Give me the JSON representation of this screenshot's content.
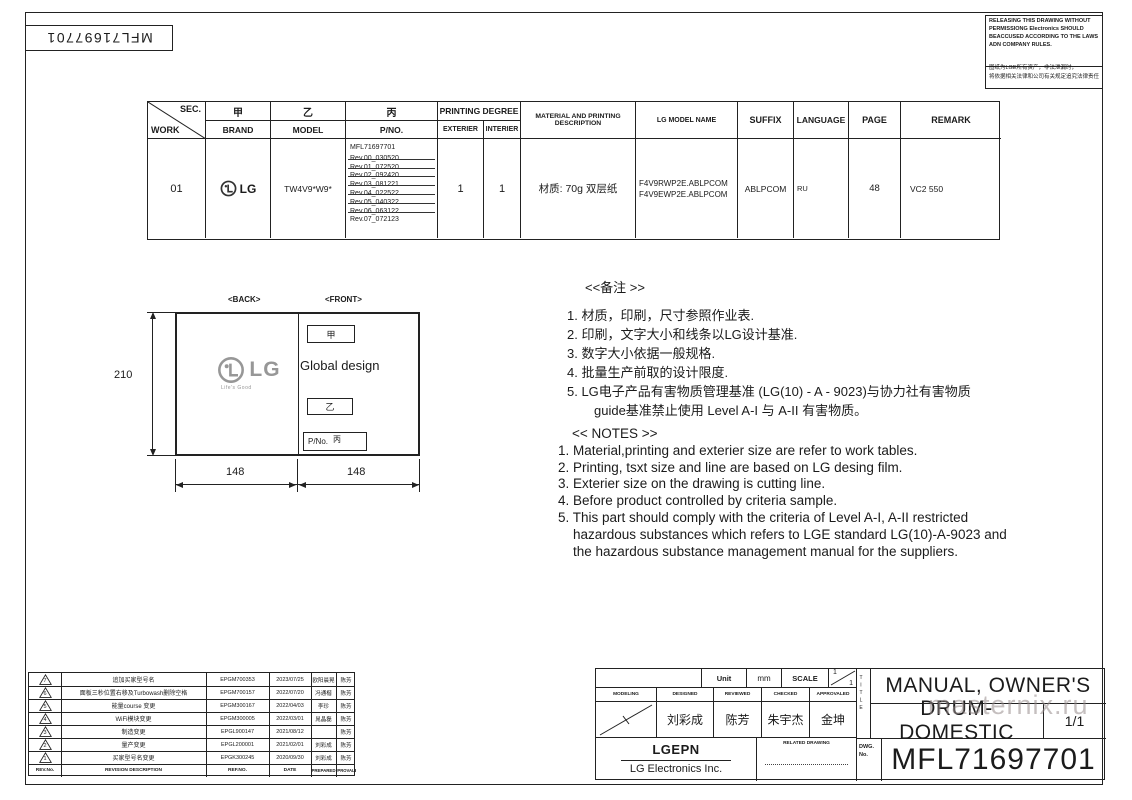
{
  "corner": {
    "doc_number": "MFL71697701"
  },
  "watermark": "masternix.ru",
  "release_box": {
    "en": "RELEASING THIS DRAWING WITHOUT PERMISSIONG Electronics SHOULD BEACCUSED ACCORDING TO THE LAWS ADN COMPANY RULES.",
    "cn_line1": "图纸为LGE所有资产，非法泄漏时，",
    "cn_line2": "将依据相关法律和公司有关规定追究法律责任"
  },
  "work_table": {
    "sec_label": "SEC.",
    "work_label": "WORK",
    "jia": "甲",
    "yi": "乙",
    "bing": "丙",
    "brand_label": "BRAND",
    "model_label": "MODEL",
    "pno_label": "P/NO.",
    "printing_degree_label": "PRINTING DEGREE",
    "exterier_label": "EXTERIER",
    "interier_label": "INTERIER",
    "material_label": "MATERIAL AND PRINTING DESCRIPTION",
    "lg_model_label": "LG MODEL NAME",
    "suffix_label": "SUFFIX",
    "language_label": "LANGUAGE",
    "page_label": "PAGE",
    "remark_label": "REMARK",
    "row": {
      "work": "01",
      "brand": "LG",
      "model": "TW4V9*W9*",
      "pno_part": "MFL71697701",
      "revs_struck": [
        "Rev.00_030520",
        "Rev.01_072520",
        "Rev.02_092420",
        "Rev.03_081221",
        "Rev.04_022522",
        "Rev.05_040322",
        "Rev.06_063122"
      ],
      "rev_current": "Rev.07_072123",
      "exterier": "1",
      "interier": "1",
      "material": "材质: 70g 双层纸",
      "lg_model_1": "F4V9RWP2E.ABLPCOM",
      "lg_model_2": "F4V9EWP2E.ABLPCOM",
      "suffix": "ABLPCOM",
      "language": "RU",
      "page": "48",
      "remark": "VC2 550"
    }
  },
  "drawing": {
    "back_label": "<BACK>",
    "front_label": "<FRONT>",
    "logo_text": "LG",
    "logo_tagline": "Life's Good",
    "front_jia": "甲",
    "front_design": "Global design",
    "front_yi": "乙",
    "front_pno_label": "P/No.",
    "front_bing": "丙",
    "dim_height": "210",
    "dim_width_left": "148",
    "dim_width_right": "148"
  },
  "notes_cn": {
    "heading": "<<备注 >>",
    "lines": [
      "1.  材质，印刷，尺寸参照作业表.",
      "2.  印刷，文字大小和线条以LG设计基准.",
      "3.  数字大小依据一般规格.",
      "4.  批量生产前取的设计限度.",
      "5.  LG电子产品有害物质管理基准 (LG(10) - A - 9023)与协力社有害物质",
      "guide基准禁止使用 Level A-I 与 A-II 有害物质。"
    ]
  },
  "notes_en": {
    "heading": "<< NOTES >>",
    "lines": [
      "1. Material,printing and exterier size are refer to work tables.",
      "2. Printing, tsxt  size and line are based on LG desing film.",
      "3. Exterier size on the drawing is cutting line.",
      "4. Before product controlled by criteria sample.",
      "5. This part should comply with the criteria of Level A-I, A-II restricted",
      "hazardous substances which refers to LGE standard LG(10)-A-9023 and",
      "the hazardous substance management manual for the suppliers."
    ]
  },
  "revision_table": {
    "rows": [
      {
        "no": "7",
        "desc": "追加买家型号名",
        "ref": "EPGM700353",
        "date": "2023/07/25",
        "prepared": "欧阳晨晃",
        "approved": "陈芳"
      },
      {
        "no": "6",
        "desc": "面板三秒位置右移及Turbowash删除空格",
        "ref": "EPGM700157",
        "date": "2022/07/20",
        "prepared": "冯通楷",
        "approved": "陈芳"
      },
      {
        "no": "5",
        "desc": "能量course 变更",
        "ref": "EPGM300167",
        "date": "2022/04/03",
        "prepared": "李珍",
        "approved": "陈芳"
      },
      {
        "no": "4",
        "desc": "WiFi模块变更",
        "ref": "EPGM300005",
        "date": "2022/03/01",
        "prepared": "晁晶磊",
        "approved": "陈芳"
      },
      {
        "no": "3",
        "desc": "制造变更",
        "ref": "EPGL900147",
        "date": "2021/08/12",
        "prepared": "",
        "approved": "陈芳"
      },
      {
        "no": "2",
        "desc": "量产变更",
        "ref": "EPGL200001",
        "date": "2021/02/01",
        "prepared": "刘彩成",
        "approved": "陈芳"
      },
      {
        "no": "1",
        "desc": "买家型号名变更",
        "ref": "EPGK300245",
        "date": "2020/09/30",
        "prepared": "刘彩成",
        "approved": "陈芳"
      }
    ],
    "footer": {
      "no": "REV.No.",
      "desc": "REVISION DESCRIPTION",
      "ref": "REF.NO.",
      "date": "DATE",
      "prepared": "PREPARED",
      "approved": "APPROVALED"
    }
  },
  "title_block": {
    "unit_label": "Unit",
    "unit_value": "mm",
    "scale_label": "SCALE",
    "scale_num": "1",
    "scale_den": "1",
    "col_modeling": "MODELING",
    "col_designed": "DESIGNED",
    "col_reviewed": "REVIEWED",
    "col_checked": "CHECKED",
    "col_approvaled": "APPROVALED",
    "designed": "刘彩成",
    "reviewed": "陈芳",
    "checked": "朱宇杰",
    "approvaled": "金坤",
    "company_1": "LGEPN",
    "company_2": "LG Electronics Inc.",
    "related_drawing_label": "RELATED DRAWING",
    "title_label": "TITLE",
    "title_line1": "MANUAL, OWNER'S",
    "title_line2": "DRUM-DOMESTIC",
    "sheet": "1/1",
    "dwg_label": "DWG.",
    "dwg_no_label": "No.",
    "dwg_no": "MFL71697701"
  }
}
